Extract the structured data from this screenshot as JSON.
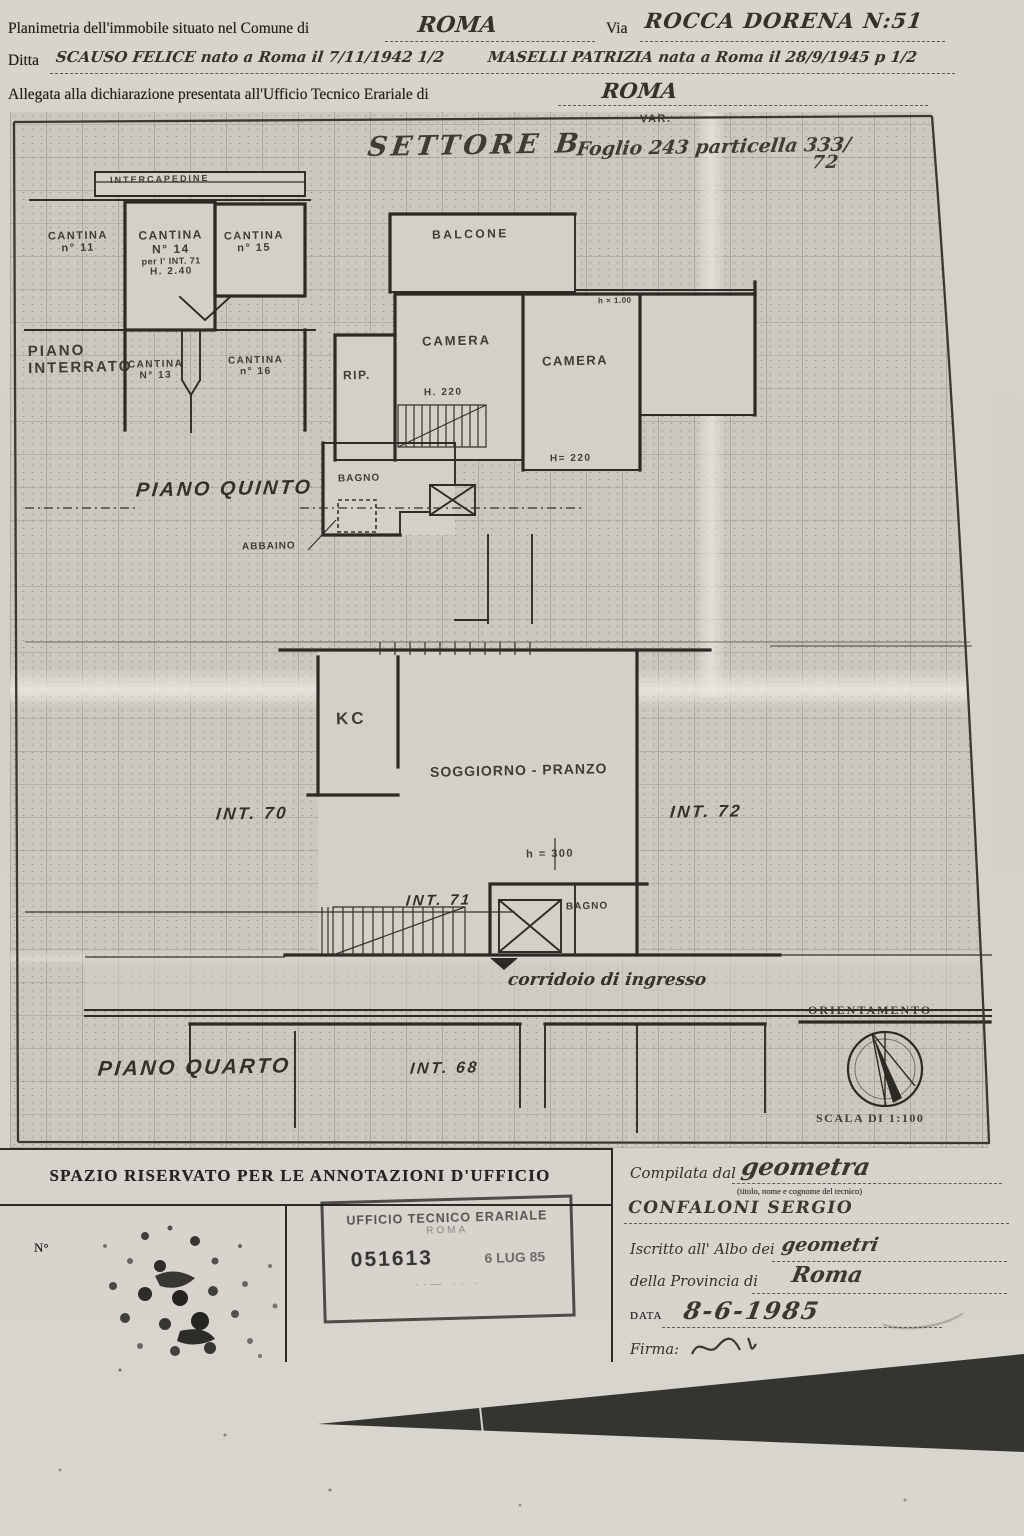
{
  "colors": {
    "paper": "#d6d2ca",
    "ink": "#2e2c27",
    "grid": "#8a867c"
  },
  "header": {
    "line1_label": "Planimetria dell'immobile situato nel Comune di",
    "line1_value": "ROMA",
    "via_label": "Via",
    "via_value": "ROCCA DORENA N:51",
    "ditta_label": "Ditta",
    "ditta_value_a": "SCAUSO FELICE nato a Roma il 7/11/1942 1/2",
    "ditta_value_b": "MASELLI PATRIZIA nata a Roma il 28/9/1945 p 1/2",
    "line3_label": "Allegata alla dichiarazione presentata all'Ufficio Tecnico Erariale di",
    "line3_value": "ROMA"
  },
  "plan": {
    "settore": "SETTORE B",
    "var_label": "VAR.",
    "foglio": "Foglio 243 particella 333/",
    "foglio_sub": "72",
    "labels": {
      "intercapedine": "INTERCAPEDINE",
      "cantina11": [
        "CANTINA",
        "n° 11"
      ],
      "cantina14": [
        "CANTINA",
        "N° 14",
        "per l' INT. 71",
        "H. 2.40"
      ],
      "cantina15": [
        "CANTINA",
        "n° 15"
      ],
      "piano_interrato": [
        "PIANO",
        "INTERRATO"
      ],
      "cantina13": [
        "CANTINA",
        "N° 13"
      ],
      "cantina16": [
        "CANTINA",
        "n° 16"
      ],
      "balcone": "BALCONE",
      "camera_left": "CAMERA",
      "h220_left": "H. 220",
      "camera_right": "CAMERA",
      "h220_right": "H= 220",
      "finestra": "h × 1.00",
      "rip": "RIP.",
      "bagno_quinto": "BAGNO",
      "abbaino": "ABBAINO",
      "piano_quinto": "PIANO QUINTO",
      "kc": "KC",
      "soggiorno": "SOGGIORNO - PRANZO",
      "h300": "h = 300",
      "int70": "INT. 70",
      "int71": "INT. 71",
      "int72": "INT. 72",
      "bagno_quarto": "BAGNO",
      "corridoio": "corridoio di ingresso",
      "piano_quarto": "PIANO QUARTO",
      "int68": "INT. 68",
      "orientamento": "ORIENTAMENTO",
      "scala": "SCALA DI 1:100"
    }
  },
  "office": {
    "title": "SPAZIO RISERVATO PER LE ANNOTAZIONI D'UFFICIO",
    "n_label": "N°",
    "stamp_line1": "UFFICIO TECNICO ERARIALE",
    "stamp_line2": "ROMA",
    "stamp_number": "051613",
    "stamp_date": "6 LUG 85"
  },
  "certifier": {
    "compilata_label": "Compilata dal",
    "compilata_value": "geometra",
    "note": "(titolo, nome e cognome del tecnico)",
    "name": "CONFALONI SERGIO",
    "albo_label": "Iscritto all' Albo dei",
    "albo_value": "geometri",
    "prov_label": "della Provincia di",
    "prov_value": "Roma",
    "data_label": "DATA",
    "data_value": "8-6-1985",
    "firma_label": "Firma:"
  }
}
